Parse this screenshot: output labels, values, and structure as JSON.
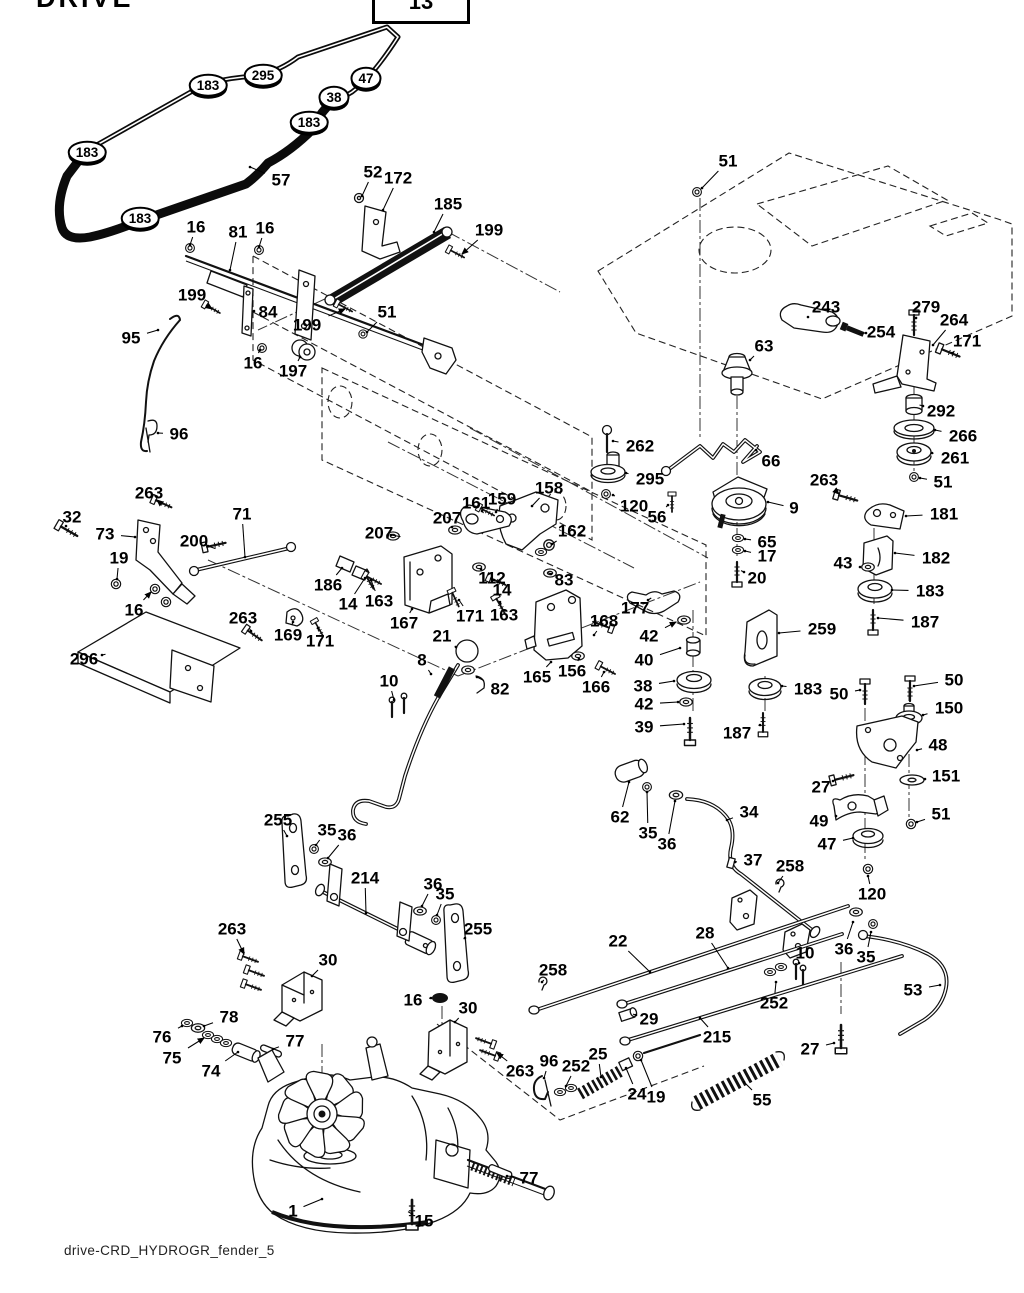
{
  "header": {
    "title": "DRIVE",
    "page_ref": "13"
  },
  "footer": {
    "caption": "drive-CRD_HYDROGR_fender_5"
  },
  "diagram": {
    "type": "exploded-parts-diagram",
    "subject": "tractor ground drive / transaxle system",
    "line_color": "#111111",
    "background": "#ffffff"
  },
  "labels": [
    {
      "t": "183",
      "x": 208,
      "y": 85,
      "c": 1
    },
    {
      "t": "295",
      "x": 263,
      "y": 75,
      "c": 1
    },
    {
      "t": "47",
      "x": 366,
      "y": 78,
      "c": 1
    },
    {
      "t": "38",
      "x": 334,
      "y": 97,
      "c": 1
    },
    {
      "t": "183",
      "x": 309,
      "y": 122,
      "c": 1
    },
    {
      "t": "183",
      "x": 87,
      "y": 152,
      "c": 1
    },
    {
      "t": "183",
      "x": 140,
      "y": 218,
      "c": 1
    },
    {
      "t": "57",
      "x": 281,
      "y": 180,
      "lx": 250,
      "ly": 167
    },
    {
      "t": "52",
      "x": 373,
      "y": 172,
      "lx": 362,
      "ly": 196
    },
    {
      "t": "172",
      "x": 398,
      "y": 178,
      "lx": 383,
      "ly": 210
    },
    {
      "t": "185",
      "x": 448,
      "y": 204,
      "lx": 434,
      "ly": 232
    },
    {
      "t": "199",
      "x": 489,
      "y": 230,
      "lx": 462,
      "ly": 254,
      "a": 1
    },
    {
      "t": "16",
      "x": 196,
      "y": 227,
      "lx": 190,
      "ly": 245
    },
    {
      "t": "81",
      "x": 238,
      "y": 232,
      "lx": 230,
      "ly": 270
    },
    {
      "t": "16",
      "x": 265,
      "y": 228,
      "lx": 259,
      "ly": 247
    },
    {
      "t": "51",
      "x": 728,
      "y": 161,
      "lx": 702,
      "ly": 188
    },
    {
      "t": "199",
      "x": 192,
      "y": 295,
      "lx": 212,
      "ly": 309,
      "a": 1
    },
    {
      "t": "84",
      "x": 268,
      "y": 312,
      "lx": 254,
      "ly": 311
    },
    {
      "t": "199",
      "x": 307,
      "y": 325,
      "lx": 345,
      "ly": 309,
      "a": 1
    },
    {
      "t": "51",
      "x": 387,
      "y": 312,
      "lx": 367,
      "ly": 332
    },
    {
      "t": "16",
      "x": 253,
      "y": 363,
      "lx": 260,
      "ly": 350
    },
    {
      "t": "197",
      "x": 293,
      "y": 371,
      "lx": 300,
      "ly": 357
    },
    {
      "t": "95",
      "x": 131,
      "y": 338,
      "lx": 158,
      "ly": 330
    },
    {
      "t": "96",
      "x": 179,
      "y": 434,
      "lx": 158,
      "ly": 433
    },
    {
      "t": "243",
      "x": 826,
      "y": 307,
      "lx": 808,
      "ly": 317
    },
    {
      "t": "254",
      "x": 881,
      "y": 332,
      "lx": 866,
      "ly": 333
    },
    {
      "t": "279",
      "x": 926,
      "y": 307,
      "lx": 916,
      "ly": 318
    },
    {
      "t": "264",
      "x": 954,
      "y": 320,
      "lx": 933,
      "ly": 345
    },
    {
      "t": "171",
      "x": 967,
      "y": 341,
      "lx": 952,
      "ly": 353
    },
    {
      "t": "63",
      "x": 764,
      "y": 346,
      "lx": 750,
      "ly": 360
    },
    {
      "t": "292",
      "x": 941,
      "y": 411,
      "lx": 923,
      "ly": 406
    },
    {
      "t": "266",
      "x": 963,
      "y": 436,
      "lx": 935,
      "ly": 430
    },
    {
      "t": "261",
      "x": 955,
      "y": 458,
      "lx": 932,
      "ly": 453
    },
    {
      "t": "51",
      "x": 943,
      "y": 482,
      "lx": 920,
      "ly": 478
    },
    {
      "t": "263",
      "x": 824,
      "y": 480,
      "lx": 839,
      "ly": 494,
      "a": 1
    },
    {
      "t": "181",
      "x": 944,
      "y": 514,
      "lx": 906,
      "ly": 516
    },
    {
      "t": "182",
      "x": 936,
      "y": 558,
      "lx": 895,
      "ly": 553
    },
    {
      "t": "43",
      "x": 843,
      "y": 563,
      "lx": 860,
      "ly": 567
    },
    {
      "t": "183",
      "x": 930,
      "y": 591,
      "lx": 892,
      "ly": 590
    },
    {
      "t": "187",
      "x": 925,
      "y": 622,
      "lx": 878,
      "ly": 618
    },
    {
      "t": "262",
      "x": 640,
      "y": 446,
      "lx": 613,
      "ly": 441
    },
    {
      "t": "295",
      "x": 650,
      "y": 479,
      "lx": 626,
      "ly": 473
    },
    {
      "t": "120",
      "x": 634,
      "y": 506,
      "lx": 613,
      "ly": 495
    },
    {
      "t": "56",
      "x": 657,
      "y": 517,
      "lx": 668,
      "ly": 505
    },
    {
      "t": "66",
      "x": 771,
      "y": 461,
      "lx": 756,
      "ly": 450
    },
    {
      "t": "9",
      "x": 794,
      "y": 508,
      "lx": 768,
      "ly": 502
    },
    {
      "t": "65",
      "x": 767,
      "y": 542,
      "lx": 745,
      "ly": 539
    },
    {
      "t": "17",
      "x": 767,
      "y": 556,
      "lx": 745,
      "ly": 551
    },
    {
      "t": "20",
      "x": 757,
      "y": 578,
      "lx": 744,
      "ly": 572
    },
    {
      "t": "158",
      "x": 549,
      "y": 488,
      "lx": 532,
      "ly": 506
    },
    {
      "t": "161",
      "x": 476,
      "y": 503,
      "lx": 482,
      "ly": 511
    },
    {
      "t": "159",
      "x": 502,
      "y": 499,
      "lx": 496,
      "ly": 512
    },
    {
      "t": "207",
      "x": 447,
      "y": 518,
      "lx": 452,
      "ly": 527
    },
    {
      "t": "207",
      "x": 379,
      "y": 533,
      "lx": 391,
      "ly": 535
    },
    {
      "t": "162",
      "x": 572,
      "y": 531,
      "lx": 552,
      "ly": 544
    },
    {
      "t": "112",
      "x": 492,
      "y": 578,
      "lx": 481,
      "ly": 569
    },
    {
      "t": "14",
      "x": 502,
      "y": 590,
      "lx": 494,
      "ly": 580
    },
    {
      "t": "83",
      "x": 564,
      "y": 580,
      "lx": 551,
      "ly": 574
    },
    {
      "t": "163",
      "x": 379,
      "y": 601,
      "lx": 371,
      "ly": 580
    },
    {
      "t": "167",
      "x": 404,
      "y": 623,
      "lx": 412,
      "ly": 609
    },
    {
      "t": "171",
      "x": 470,
      "y": 616,
      "lx": 459,
      "ly": 600
    },
    {
      "t": "163",
      "x": 504,
      "y": 615,
      "lx": 500,
      "ly": 602
    },
    {
      "t": "168",
      "x": 604,
      "y": 621,
      "lx": 594,
      "ly": 635
    },
    {
      "t": "21",
      "x": 442,
      "y": 636,
      "lx": 456,
      "ly": 647
    },
    {
      "t": "8",
      "x": 422,
      "y": 660,
      "lx": 431,
      "ly": 674
    },
    {
      "t": "10",
      "x": 389,
      "y": 681,
      "lx": 394,
      "ly": 700
    },
    {
      "t": "82",
      "x": 500,
      "y": 689,
      "lx": 477,
      "ly": 677
    },
    {
      "t": "165",
      "x": 537,
      "y": 677,
      "lx": 551,
      "ly": 662
    },
    {
      "t": "156",
      "x": 572,
      "y": 671,
      "lx": 579,
      "ly": 659
    },
    {
      "t": "166",
      "x": 596,
      "y": 687,
      "lx": 604,
      "ly": 672
    },
    {
      "t": "177",
      "x": 635,
      "y": 608,
      "lx": 648,
      "ly": 600
    },
    {
      "t": "42",
      "x": 649,
      "y": 636,
      "lx": 676,
      "ly": 622,
      "a": 1
    },
    {
      "t": "40",
      "x": 644,
      "y": 660,
      "lx": 680,
      "ly": 648
    },
    {
      "t": "38",
      "x": 643,
      "y": 686,
      "lx": 674,
      "ly": 681
    },
    {
      "t": "42",
      "x": 644,
      "y": 704,
      "lx": 678,
      "ly": 702
    },
    {
      "t": "39",
      "x": 644,
      "y": 727,
      "lx": 684,
      "ly": 724
    },
    {
      "t": "259",
      "x": 822,
      "y": 629,
      "lx": 779,
      "ly": 633
    },
    {
      "t": "183",
      "x": 808,
      "y": 689,
      "lx": 782,
      "ly": 686
    },
    {
      "t": "187",
      "x": 737,
      "y": 733,
      "lx": 760,
      "ly": 725
    },
    {
      "t": "50",
      "x": 839,
      "y": 694,
      "lx": 860,
      "ly": 690
    },
    {
      "t": "50",
      "x": 954,
      "y": 680,
      "lx": 914,
      "ly": 686
    },
    {
      "t": "150",
      "x": 949,
      "y": 708,
      "lx": 923,
      "ly": 715
    },
    {
      "t": "48",
      "x": 938,
      "y": 745,
      "lx": 917,
      "ly": 750
    },
    {
      "t": "27",
      "x": 821,
      "y": 787,
      "lx": 833,
      "ly": 781
    },
    {
      "t": "151",
      "x": 946,
      "y": 776,
      "lx": 925,
      "ly": 779
    },
    {
      "t": "51",
      "x": 941,
      "y": 814,
      "lx": 917,
      "ly": 822
    },
    {
      "t": "49",
      "x": 819,
      "y": 821,
      "lx": 836,
      "ly": 816
    },
    {
      "t": "47",
      "x": 827,
      "y": 844,
      "lx": 853,
      "ly": 838
    },
    {
      "t": "120",
      "x": 872,
      "y": 894,
      "lx": 868,
      "ly": 876
    },
    {
      "t": "62",
      "x": 620,
      "y": 817,
      "lx": 629,
      "ly": 782
    },
    {
      "t": "35",
      "x": 648,
      "y": 833,
      "lx": 647,
      "ly": 792
    },
    {
      "t": "36",
      "x": 667,
      "y": 844,
      "lx": 675,
      "ly": 801
    },
    {
      "t": "34",
      "x": 749,
      "y": 812,
      "lx": 727,
      "ly": 820
    },
    {
      "t": "37",
      "x": 753,
      "y": 860,
      "lx": 735,
      "ly": 862
    },
    {
      "t": "258",
      "x": 790,
      "y": 866,
      "lx": 778,
      "ly": 883
    },
    {
      "t": "22",
      "x": 618,
      "y": 941,
      "lx": 650,
      "ly": 972
    },
    {
      "t": "28",
      "x": 705,
      "y": 933,
      "lx": 728,
      "ly": 968
    },
    {
      "t": "10",
      "x": 805,
      "y": 953,
      "lx": 799,
      "ly": 963
    },
    {
      "t": "36",
      "x": 844,
      "y": 949,
      "lx": 853,
      "ly": 922
    },
    {
      "t": "35",
      "x": 866,
      "y": 957,
      "lx": 871,
      "ly": 932
    },
    {
      "t": "53",
      "x": 913,
      "y": 990,
      "lx": 940,
      "ly": 985
    },
    {
      "t": "252",
      "x": 774,
      "y": 1003,
      "lx": 776,
      "ly": 982
    },
    {
      "t": "215",
      "x": 717,
      "y": 1037,
      "lx": 700,
      "ly": 1018
    },
    {
      "t": "27",
      "x": 810,
      "y": 1049,
      "lx": 834,
      "ly": 1043
    },
    {
      "t": "55",
      "x": 762,
      "y": 1100,
      "lx": 744,
      "ly": 1082
    },
    {
      "t": "258",
      "x": 553,
      "y": 970,
      "lx": 542,
      "ly": 982
    },
    {
      "t": "29",
      "x": 649,
      "y": 1019,
      "lx": 636,
      "ly": 1015
    },
    {
      "t": "96",
      "x": 549,
      "y": 1061,
      "lx": 544,
      "ly": 1078
    },
    {
      "t": "252",
      "x": 576,
      "y": 1066,
      "lx": 566,
      "ly": 1086
    },
    {
      "t": "25",
      "x": 598,
      "y": 1054,
      "lx": 601,
      "ly": 1077
    },
    {
      "t": "24",
      "x": 637,
      "y": 1094,
      "lx": 626,
      "ly": 1068
    },
    {
      "t": "19",
      "x": 656,
      "y": 1097,
      "lx": 641,
      "ly": 1060
    },
    {
      "t": "263",
      "x": 149,
      "y": 493,
      "lx": 157,
      "ly": 500,
      "a": 1
    },
    {
      "t": "32",
      "x": 72,
      "y": 517,
      "lx": 66,
      "ly": 526
    },
    {
      "t": "73",
      "x": 105,
      "y": 534,
      "lx": 135,
      "ly": 537
    },
    {
      "t": "200",
      "x": 194,
      "y": 541,
      "lx": 208,
      "ly": 546
    },
    {
      "t": "71",
      "x": 242,
      "y": 514,
      "lx": 245,
      "ly": 557
    },
    {
      "t": "19",
      "x": 119,
      "y": 558,
      "lx": 117,
      "ly": 579
    },
    {
      "t": "16",
      "x": 134,
      "y": 610,
      "lx": 151,
      "ly": 592,
      "a": 1
    },
    {
      "t": "263",
      "x": 243,
      "y": 618,
      "lx": 251,
      "ly": 631
    },
    {
      "t": "296",
      "x": 84,
      "y": 659,
      "lx": 102,
      "ly": 655
    },
    {
      "t": "169",
      "x": 288,
      "y": 635,
      "lx": 293,
      "ly": 622
    },
    {
      "t": "171",
      "x": 320,
      "y": 641,
      "lx": 318,
      "ly": 628
    },
    {
      "t": "186",
      "x": 328,
      "y": 585,
      "lx": 342,
      "ly": 568
    },
    {
      "t": "14",
      "x": 348,
      "y": 604,
      "lx": 365,
      "ly": 578
    },
    {
      "t": "255",
      "x": 278,
      "y": 820,
      "lx": 287,
      "ly": 836
    },
    {
      "t": "35",
      "x": 327,
      "y": 830,
      "lx": 316,
      "ly": 845
    },
    {
      "t": "36",
      "x": 347,
      "y": 835,
      "lx": 328,
      "ly": 858
    },
    {
      "t": "214",
      "x": 365,
      "y": 878,
      "lx": 366,
      "ly": 913
    },
    {
      "t": "36",
      "x": 433,
      "y": 884,
      "lx": 422,
      "ly": 906
    },
    {
      "t": "35",
      "x": 445,
      "y": 894,
      "lx": 437,
      "ly": 915
    },
    {
      "t": "255",
      "x": 478,
      "y": 929,
      "lx": 465,
      "ly": 938
    },
    {
      "t": "263",
      "x": 232,
      "y": 929,
      "lx": 244,
      "ly": 954,
      "a": 1
    },
    {
      "t": "30",
      "x": 328,
      "y": 960,
      "lx": 312,
      "ly": 976
    },
    {
      "t": "16",
      "x": 413,
      "y": 1000,
      "lx": 431,
      "ly": 998
    },
    {
      "t": "30",
      "x": 468,
      "y": 1008,
      "lx": 455,
      "ly": 1022
    },
    {
      "t": "263",
      "x": 520,
      "y": 1071,
      "lx": 497,
      "ly": 1053,
      "a": 1
    },
    {
      "t": "76",
      "x": 162,
      "y": 1037,
      "lx": 182,
      "ly": 1026
    },
    {
      "t": "78",
      "x": 229,
      "y": 1017,
      "lx": 204,
      "ly": 1026
    },
    {
      "t": "75",
      "x": 172,
      "y": 1058,
      "lx": 204,
      "ly": 1038,
      "a": 1
    },
    {
      "t": "74",
      "x": 211,
      "y": 1071,
      "lx": 238,
      "ly": 1052
    },
    {
      "t": "77",
      "x": 295,
      "y": 1041,
      "lx": 273,
      "ly": 1049
    },
    {
      "t": "1",
      "x": 293,
      "y": 1211,
      "lx": 322,
      "ly": 1199
    },
    {
      "t": "15",
      "x": 424,
      "y": 1221,
      "lx": 412,
      "ly": 1214
    },
    {
      "t": "77",
      "x": 529,
      "y": 1178,
      "lx": 507,
      "ly": 1176
    }
  ]
}
